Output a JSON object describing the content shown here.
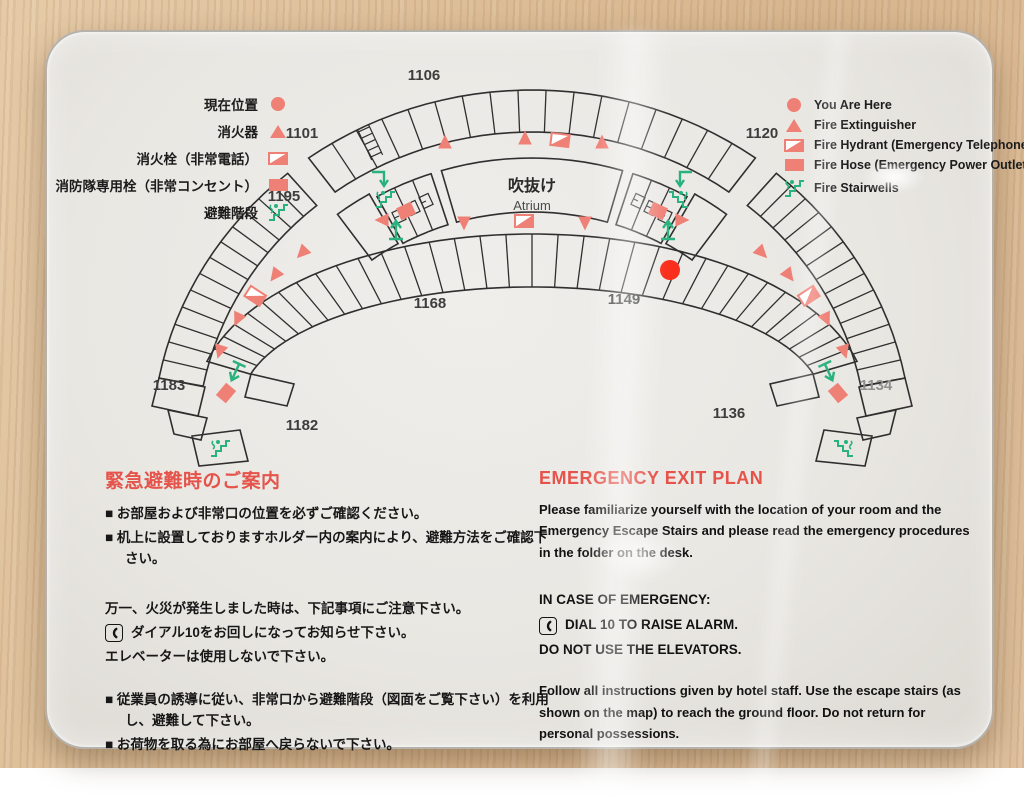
{
  "colors": {
    "accent_red": "#e5534b",
    "icon_salmon": "#ef8076",
    "alarm_red": "#fa2e1c",
    "stair_green": "#29b27e",
    "line": "#2f2f2f"
  },
  "legend_left": {
    "items": [
      {
        "icon": "here-dot",
        "label": "現在位置"
      },
      {
        "icon": "fire-extinguisher",
        "label": "消火器"
      },
      {
        "icon": "fire-hydrant",
        "label": "消火栓（非常電話）"
      },
      {
        "icon": "fire-hose",
        "label": "消防隊専用栓（非常コンセント）"
      },
      {
        "icon": "fire-stairs",
        "label": "避難階段"
      }
    ]
  },
  "legend_right": {
    "items": [
      {
        "icon": "here-dot",
        "label": "You Are Here"
      },
      {
        "icon": "fire-extinguisher",
        "label": "Fire Extinguisher"
      },
      {
        "icon": "fire-hydrant",
        "label": "Fire Hydrant (Emergency Telephone)"
      },
      {
        "icon": "fire-hose",
        "label": "Fire Hose (Emergency Power Outlet)"
      },
      {
        "icon": "fire-stairs",
        "label": "Fire Stairwells"
      }
    ]
  },
  "map": {
    "atrium_jp": "吹抜け",
    "atrium_en": "Atrium",
    "rooms": [
      "1106",
      "1101",
      "1120",
      "1195",
      "1168",
      "1149",
      "1183",
      "1182",
      "1136",
      "1134"
    ]
  },
  "jp_section": {
    "heading": "緊急避難時のご案内",
    "bullet_char": "■",
    "bullets_a": [
      "お部屋および非常口の位置を必ずご確認ください。",
      "机上に設置しておりますホルダー内の案内により、避難方法をご確認下さい。"
    ],
    "notice_intro": "万一、火災が発生しました時は、下記事項にご注意下さい。",
    "dial_line": "ダイアル10をお回しになってお知らせ下さい。",
    "elevator_line": "エレベーターは使用しないで下さい。",
    "bullets_b": [
      "従業員の誘導に従い、非常口から避難階段（図面をご覧下さい）を利用し、避難して下さい。",
      "お荷物を取る為にお部屋へ戻らないで下さい。"
    ]
  },
  "en_section": {
    "heading": "EMERGENCY EXIT PLAN",
    "para1": "Please familiarize yourself with the location of your room and the Emergency Escape Stairs and please read the emergency procedures in the folder on the desk.",
    "case_heading": "IN CASE OF EMERGENCY:",
    "dial_line": "DIAL 10 TO RAISE ALARM.",
    "elevator_line": "DO NOT USE THE ELEVATORS.",
    "para2": "Follow all instructions given by hotel staff. Use the escape stairs (as shown on the map) to reach the ground floor. Do not return for personal possessions."
  }
}
